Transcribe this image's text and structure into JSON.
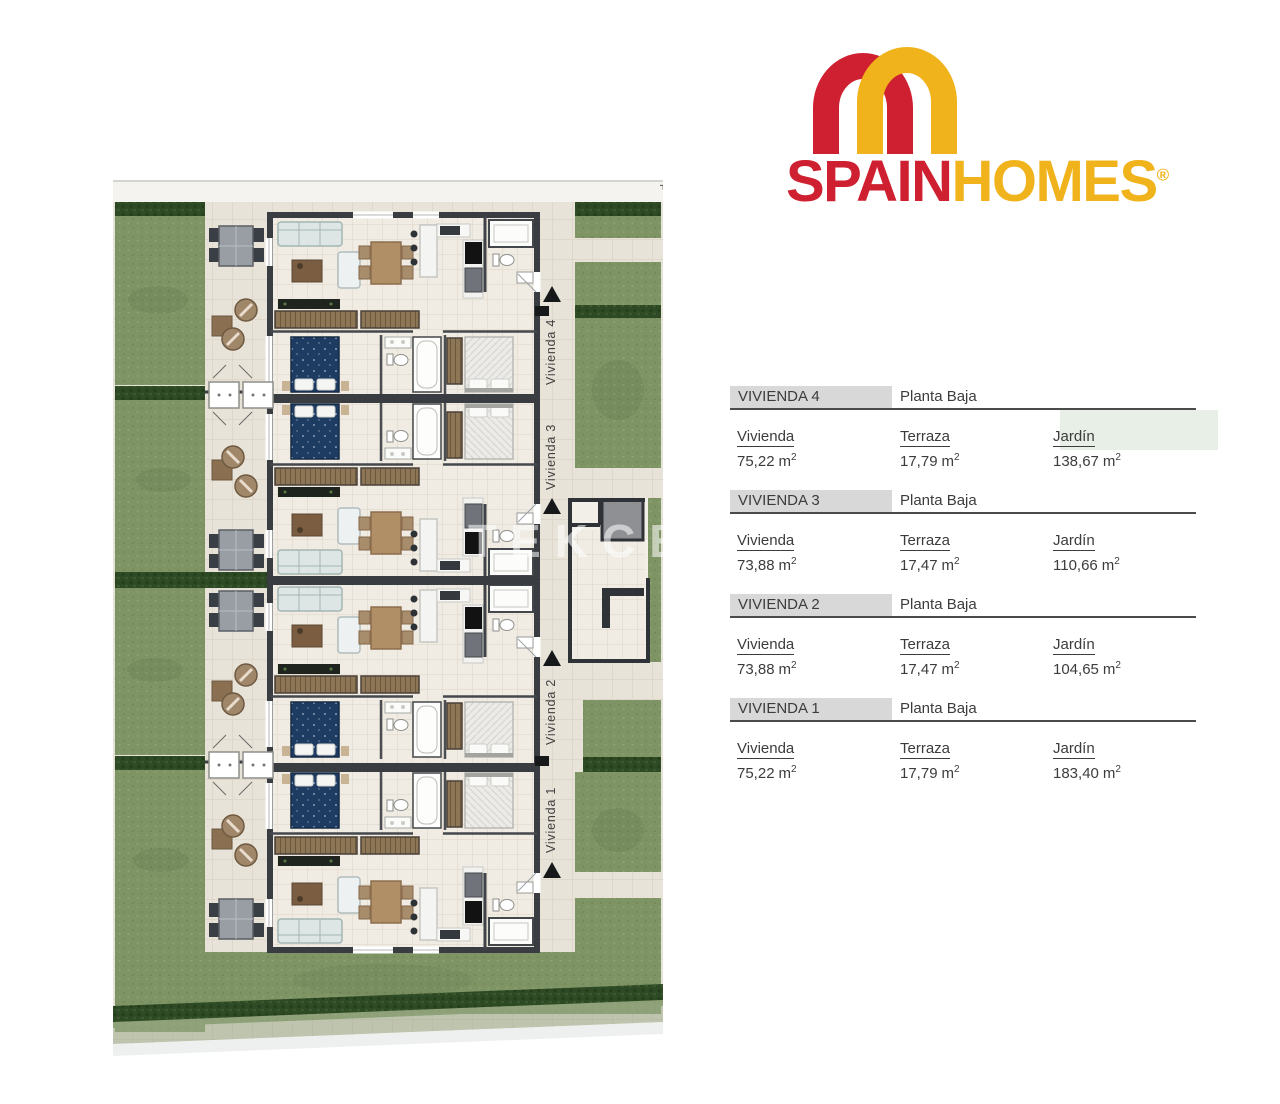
{
  "brand": {
    "word_spain": "SPAIN",
    "word_homes": "HOMES",
    "registered": "®",
    "color_red": "#ce2030",
    "color_gold": "#f0b31c"
  },
  "floor_plan": {
    "corner_mark": "F",
    "watermark": "TEKCE",
    "unit_labels": [
      {
        "label": "Vivienda 4"
      },
      {
        "label": "Vivienda 3"
      },
      {
        "label": "Vivienda 2"
      },
      {
        "label": "Vivienda 1"
      }
    ],
    "colors": {
      "garden": "#7e9464",
      "hedge": "#2e4a24",
      "pavement": "#e8e3d9",
      "wall": "#393c40",
      "interior": "#f0ece4",
      "bed_navy": "#1e3c62"
    }
  },
  "units_table": {
    "sections": [
      {
        "name": "VIVIENDA 4",
        "floor": "Planta Baja",
        "metrics": [
          {
            "label": "Vivienda",
            "value": "75,22",
            "unit": "m",
            "sup": "2"
          },
          {
            "label": "Terraza",
            "value": "17,79",
            "unit": "m",
            "sup": "2"
          },
          {
            "label": "Jardín",
            "value": "138,67",
            "unit": "m",
            "sup": "2"
          }
        ]
      },
      {
        "name": "VIVIENDA 3",
        "floor": "Planta Baja",
        "metrics": [
          {
            "label": "Vivienda",
            "value": "73,88",
            "unit": "m",
            "sup": "2"
          },
          {
            "label": "Terraza",
            "value": "17,47",
            "unit": "m",
            "sup": "2"
          },
          {
            "label": "Jardín",
            "value": "110,66",
            "unit": "m",
            "sup": "2"
          }
        ]
      },
      {
        "name": "VIVIENDA 2",
        "floor": "Planta Baja",
        "metrics": [
          {
            "label": "Vivienda",
            "value": "73,88",
            "unit": "m",
            "sup": "2"
          },
          {
            "label": "Terraza",
            "value": "17,47",
            "unit": "m",
            "sup": "2"
          },
          {
            "label": "Jardín",
            "value": "104,65",
            "unit": "m",
            "sup": "2"
          }
        ]
      },
      {
        "name": "VIVIENDA 1",
        "floor": "Planta Baja",
        "metrics": [
          {
            "label": "Vivienda",
            "value": "75,22",
            "unit": "m",
            "sup": "2"
          },
          {
            "label": "Terraza",
            "value": "17,79",
            "unit": "m",
            "sup": "2"
          },
          {
            "label": "Jardín",
            "value": "183,40",
            "unit": "m",
            "sup": "2"
          }
        ]
      }
    ]
  }
}
